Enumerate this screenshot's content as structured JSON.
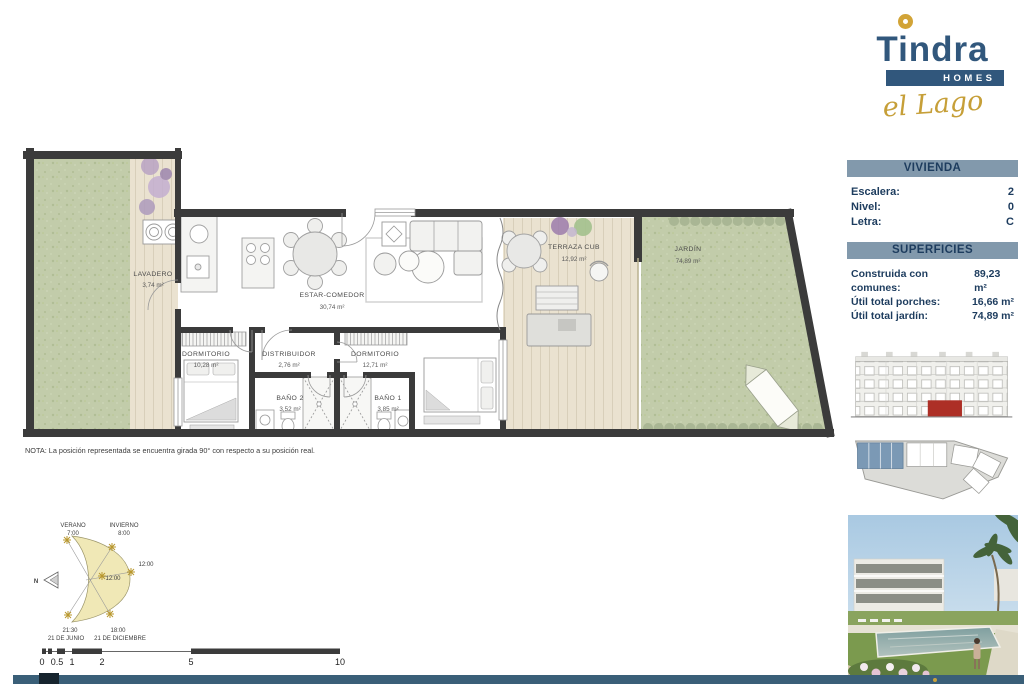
{
  "logo": {
    "brand": "Tindra",
    "homes": "HOMES",
    "subbrand": "el Lago"
  },
  "vivienda": {
    "title": "VIVIENDA",
    "rows": [
      {
        "label": "Escalera:",
        "value": "2"
      },
      {
        "label": "Nivel:",
        "value": "0"
      },
      {
        "label": "Letra:",
        "value": "C"
      }
    ]
  },
  "superficies": {
    "title": "SUPERFICIES",
    "rows": [
      {
        "label": "Construida con comunes:",
        "value": "89,23 m²"
      },
      {
        "label": "Útil total porches:",
        "value": "16,66 m²"
      },
      {
        "label": "Útil total jardín:",
        "value": "74,89 m²"
      }
    ]
  },
  "plan": {
    "note": "NOTA: La posición representada se encuentra girada 90° con respecto a su posición real.",
    "rooms": [
      {
        "name": "LAVADERO",
        "area": "3,74 m²"
      },
      {
        "name": "ESTAR-COMEDOR",
        "area": "30,74 m²"
      },
      {
        "name": "DORMITORIO",
        "area": "10,28 m²"
      },
      {
        "name": "DISTRIBUIDOR",
        "area": "2,76 m²"
      },
      {
        "name": "DORMITORIO",
        "area": "12,71 m²"
      },
      {
        "name": "BAÑO 2",
        "area": "3,52 m²"
      },
      {
        "name": "BAÑO 1",
        "area": "3,85 m²"
      },
      {
        "name": "TERRAZA CUB",
        "area": "12,92 m²"
      },
      {
        "name": "JARDÍN",
        "area": "74,89 m²"
      }
    ]
  },
  "sun_diagram": {
    "verano_label": "VERANO",
    "verano_time": "7:00",
    "invierno_label": "INVIERNO",
    "invierno_time": "8:00",
    "noon_right": "12:00",
    "noon_center": "12:00",
    "summer_end_time": "21:30",
    "summer_end_date": "21 DE JUNIO",
    "winter_end_time": "18:00",
    "winter_end_date": "21 DE DICIEMBRE",
    "north": "N"
  },
  "scale_bar": {
    "ticks": [
      "0",
      "0.5",
      "1",
      "2",
      "5",
      "10"
    ]
  },
  "colors": {
    "brand_navy": "#31577c",
    "brand_gold": "#d2a437",
    "header_bar": "#8299ac",
    "header_text": "#1d3c5e",
    "wall": "#3b3b3b",
    "grass": "#c2ccaa",
    "deck": "#eae2d0",
    "unit_highlight_red": "#ad2f26",
    "siteplan_highlight_blue": "#7b99b5",
    "footer_bar": "#3a5f78"
  }
}
